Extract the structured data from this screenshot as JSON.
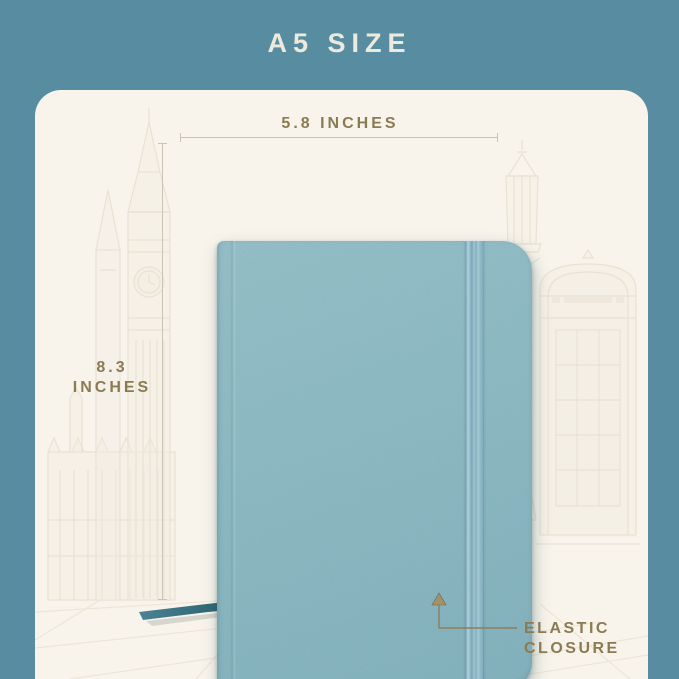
{
  "banner": {
    "title": "A5 SIZE",
    "background_color": "#588da1",
    "text_color": "#eceade"
  },
  "card": {
    "background_color": "#f8f4eb"
  },
  "product": {
    "name": "a5-notebook",
    "cover_color": "#86b4be",
    "elastic_band_color": "#93becc",
    "bookmark_ribbon_color": "#2e6b78"
  },
  "dimensions": {
    "label_color": "#8a7b52",
    "line_color": "#c8c3b5",
    "width": {
      "label": "5.8 INCHES"
    },
    "height": {
      "label_value": "8.3",
      "label_unit": "INCHES"
    }
  },
  "callout": {
    "label_line1": "ELASTIC",
    "label_line2": "CLOSURE",
    "text_color": "#8a7b52",
    "line_color": "#8d7f5c"
  },
  "sketch_icons": [
    "big-ben-sketch",
    "westminster-palace-sketch",
    "lamp-post-sketch",
    "phone-booth-sketch",
    "pedestrian-sketch",
    "pavement-lines-sketch"
  ]
}
